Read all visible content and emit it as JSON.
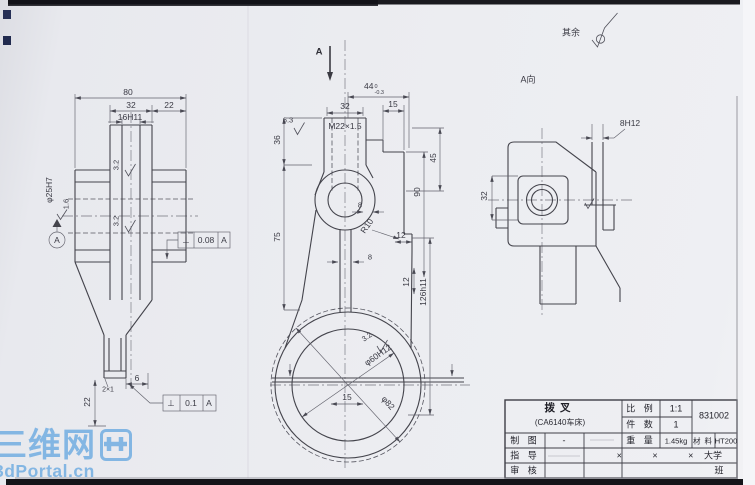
{
  "scan": {
    "paper_color": "#ebecf1",
    "ink_color": "#44444c",
    "watermark_color": "#7cb3e3"
  },
  "annotations": {
    "section_arrow": "A",
    "view_label": "A向",
    "others_finish_label": "其余"
  },
  "views": {
    "front": {
      "dims": {
        "overall_width": "80",
        "boss_width": "32",
        "flange_width": "22",
        "slot_width": "16H11",
        "slot_finish_upper": "3.2",
        "slot_finish_lower": "3.2",
        "bore": "φ25H7",
        "bore_finish": "1.6",
        "datum_label": "A",
        "groove": "2×1",
        "face_offset": "6",
        "pad_height": "22"
      },
      "tolerance_frames": [
        {
          "symbol": "⊥",
          "value": "0.08",
          "datum": "A"
        },
        {
          "symbol": "⊥",
          "value": "0.1",
          "datum": "A"
        }
      ]
    },
    "main": {
      "dims": {
        "top_width_base": "44",
        "top_width_upper": "0",
        "top_width_lower": "-0.3",
        "thread_boss_width": "32",
        "thread_spec": "M22×1.5",
        "thread_face_finish": "6.3",
        "step_width": "15",
        "right_step_height": "45",
        "left_upper_height": "36",
        "right_mid_height": "90",
        "boss_step": "8",
        "left_lower_height": "75",
        "fillet_radius": "R10",
        "notch_width": "12",
        "stem_width": "8",
        "notch_height": "12",
        "overall_height": "126h11",
        "jaw_finish": "3.2",
        "jaw_bore": "φ60H12",
        "jaw_outer": "φ82",
        "jaw_offset": "15"
      }
    },
    "aux": {
      "dims": {
        "slot_width": "8H12",
        "bore_boss_height": "32"
      }
    }
  },
  "title_block": {
    "part_name": "拨叉",
    "part_sub": "(CA6140车床)",
    "scale_label": "比 例",
    "scale_value": "1:1",
    "qty_label": "件 数",
    "qty_value": "1",
    "drawing_no": "831002",
    "draft_label": "制 图",
    "draft_value": "-",
    "weight_label": "重 量",
    "weight_value": "1.45kg",
    "material_label": "材 料",
    "material_value": "HT200",
    "advisor_label": "指 导",
    "check_label": "审 核",
    "school_marks": "× × ×",
    "school": "大学",
    "class_label": "班"
  },
  "watermark": {
    "site_name": "三维网",
    "site_url": "3dPortal.cn"
  }
}
